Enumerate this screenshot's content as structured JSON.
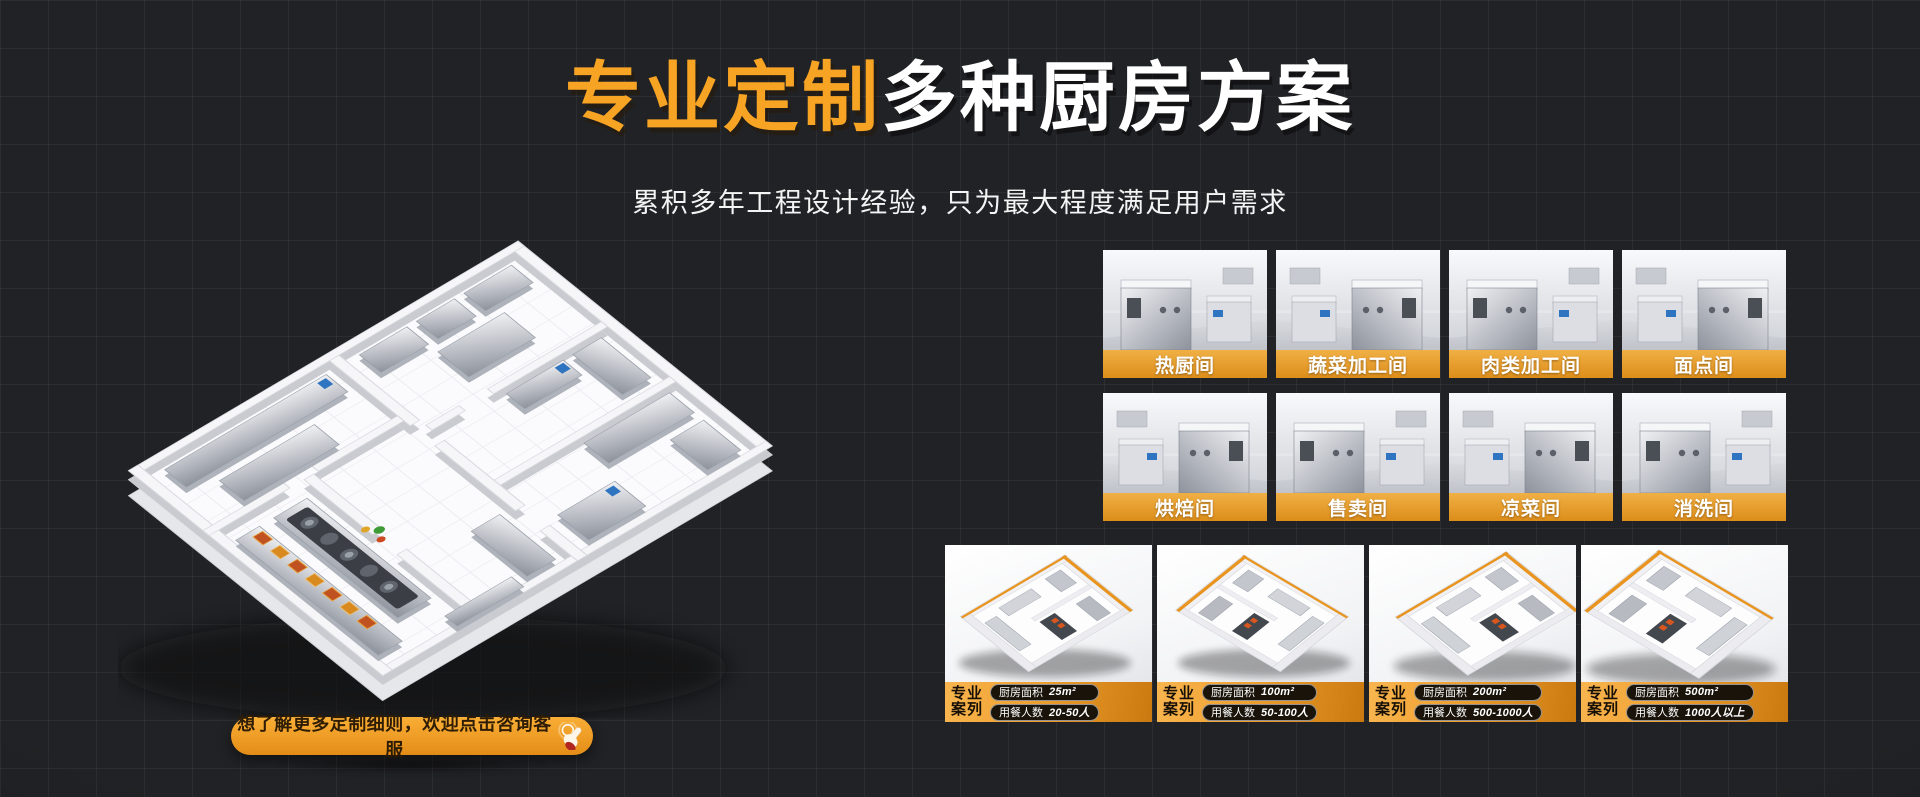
{
  "title": {
    "highlight": "专业定制",
    "rest": "多种厨房方案"
  },
  "subtitle": "累积多年工程设计经验，只为最大程度满足用户需求",
  "cta": {
    "label": "想了解更多定制细则，欢迎点击咨询客服",
    "icon": "hand-click-icon"
  },
  "colors": {
    "accent": "#F7A324",
    "band_orange": "#E8941E",
    "background": "#212225"
  },
  "rooms": [
    {
      "label": "热厨间"
    },
    {
      "label": "蔬菜加工间"
    },
    {
      "label": "肉类加工间"
    },
    {
      "label": "面点间"
    },
    {
      "label": "烘焙间"
    },
    {
      "label": "售卖间"
    },
    {
      "label": "凉菜间"
    },
    {
      "label": "消洗间"
    }
  ],
  "cases": [
    {
      "tag_line1": "专业",
      "tag_line2": "案列",
      "area_label": "厨房面积",
      "area_value": "25m²",
      "diners_label": "用餐人数",
      "diners_value": "20-50人"
    },
    {
      "tag_line1": "专业",
      "tag_line2": "案列",
      "area_label": "厨房面积",
      "area_value": "100m²",
      "diners_label": "用餐人数",
      "diners_value": "50-100人"
    },
    {
      "tag_line1": "专业",
      "tag_line2": "案列",
      "area_label": "厨房面积",
      "area_value": "200m²",
      "diners_label": "用餐人数",
      "diners_value": "500-1000人"
    },
    {
      "tag_line1": "专业",
      "tag_line2": "案列",
      "area_label": "厨房面积",
      "area_value": "500m²",
      "diners_label": "用餐人数",
      "diners_value": "1000人以上"
    }
  ]
}
